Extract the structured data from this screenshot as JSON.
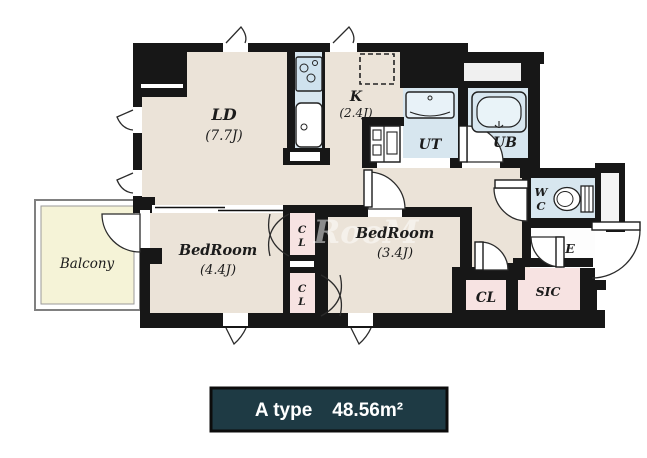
{
  "plan_title": "floor-plan",
  "badge": {
    "type_label": "A type",
    "area_label": "48.56m²"
  },
  "watermark": "RooM",
  "rooms": {
    "ld": {
      "label": "LD",
      "area": "(7.7J)"
    },
    "kitchen": {
      "label": "K",
      "area": "(2.4J)"
    },
    "ut": {
      "label": "UT"
    },
    "ub": {
      "label": "UB"
    },
    "wc": {
      "line1": "W",
      "line2": "C"
    },
    "bedroom_44": {
      "label": "BedRoom",
      "area": "(4.4J)"
    },
    "bedroom_34": {
      "label": "BedRoom",
      "area": "(3.4J)"
    },
    "closet_upper": {
      "line1": "C",
      "line2": "L"
    },
    "closet_lower": {
      "line1": "C",
      "line2": "L"
    },
    "closet_hall": {
      "label": "CL"
    },
    "sic": {
      "label": "SIC"
    },
    "entrance": {
      "label": "E"
    },
    "balcony": {
      "label": "Balcony"
    }
  },
  "icons": [
    "stove-icon",
    "kitchen-sink-icon",
    "refrigerator-dashed-space",
    "washer-space-icon",
    "vanity-sink-icon",
    "bathtub-icon",
    "toilet-icon"
  ],
  "colors": {
    "wall": "#171717",
    "floor": "#ebe3d8",
    "wet_area": "#d7e6ef",
    "closet": "#f7e3e2",
    "balcony": "#f5f3d7",
    "badge_bg": "#1e3a44",
    "badge_text": "#ffffff"
  }
}
